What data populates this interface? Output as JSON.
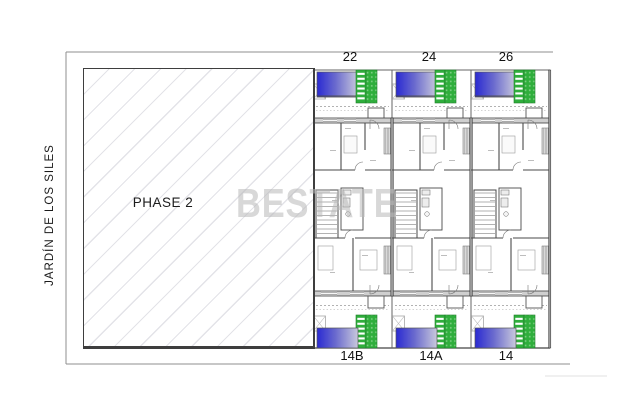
{
  "street_label": "JARDÍN DE LOS SILES",
  "phase": {
    "label": "PHASE 2"
  },
  "watermark": "BESTATE",
  "units": {
    "top": [
      {
        "number": "22"
      },
      {
        "number": "24"
      },
      {
        "number": "26"
      }
    ],
    "bottom": [
      {
        "number": "14B"
      },
      {
        "number": "14A"
      },
      {
        "number": "14"
      }
    ]
  },
  "features": {
    "pool": "swimming-pool",
    "deck": "green-slatted-deck",
    "stairs": "staircase",
    "hatched_area": "phase-2-future-plot"
  },
  "colors": {
    "pool_dark": "#2a2ad2",
    "pool_mid": "#6a6ace",
    "pool_light": "#c9c9dc",
    "deck_green": "#2fae3c",
    "deck_dot": "#77cd7e",
    "deck_edge": "#1f7d2a",
    "hatch_line": "#e3e3e8",
    "wall_fill": "#9a9a9a",
    "wall_line": "#3d3d3d",
    "thin_line": "#666666",
    "border_gray": "#8f8f8f",
    "faint_gray": "#e0e0e0",
    "watermark_gray": "#b9b9b9"
  }
}
